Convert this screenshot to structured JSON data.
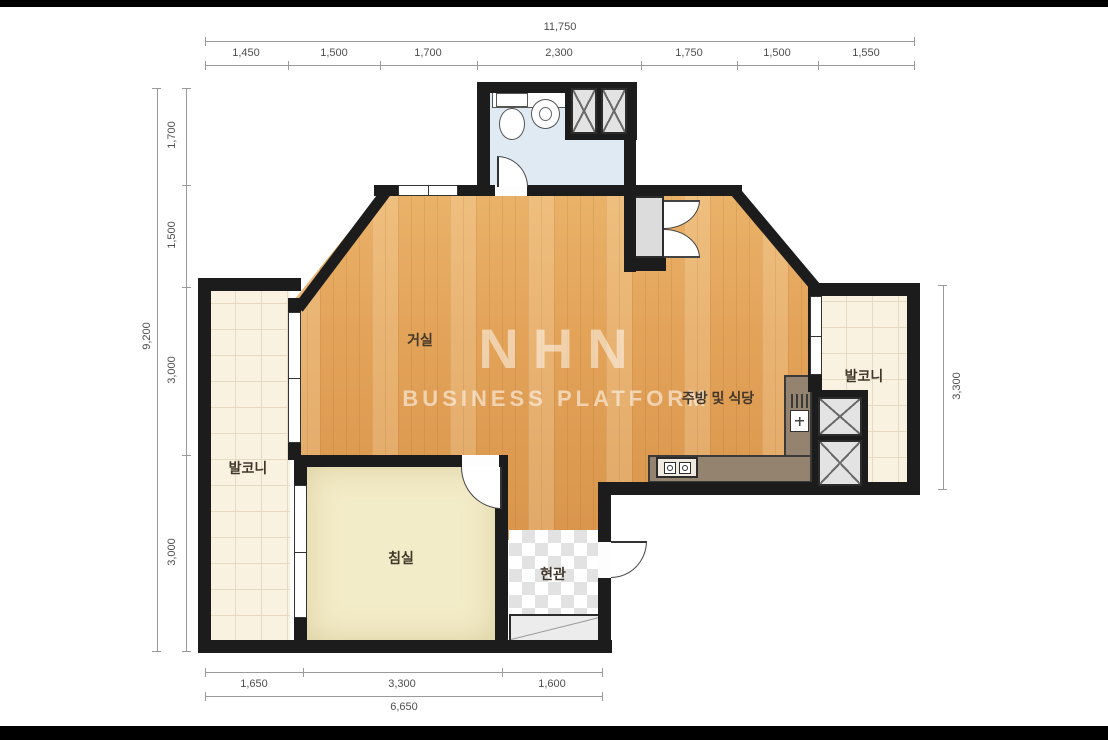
{
  "watermark": {
    "line1": "NHN",
    "line2": "BUSINESS PLATFORM"
  },
  "rooms": {
    "living_room": "거실",
    "kitchen_dining": "주방 및 식당",
    "balcony_left": "발코니",
    "balcony_right": "발코니",
    "bedroom": "침실",
    "entrance": "현관"
  },
  "dimensions": {
    "top_total": "11,750",
    "top_segments": [
      "1,450",
      "1,500",
      "1,700",
      "2,300",
      "1,750",
      "1,500",
      "1,550"
    ],
    "left_total": "9,200",
    "left_segments": [
      "1,700",
      "1,500",
      "3,000",
      "3,000"
    ],
    "right_total": "3,300",
    "bottom_segments": [
      "1,650",
      "3,300",
      "1,600"
    ],
    "bottom_total": "6,650"
  },
  "colors": {
    "wall": "#1c1c1c",
    "wood_floor": "#e2a258",
    "bedroom_floor": "#f3ecc8",
    "balcony_tile": "#f9f2e1",
    "bathroom_floor": "#dfeaf2",
    "entrance_tile": "#e2e2e2",
    "counter": "#94836f",
    "dimension_text": "#4e4e4e"
  }
}
